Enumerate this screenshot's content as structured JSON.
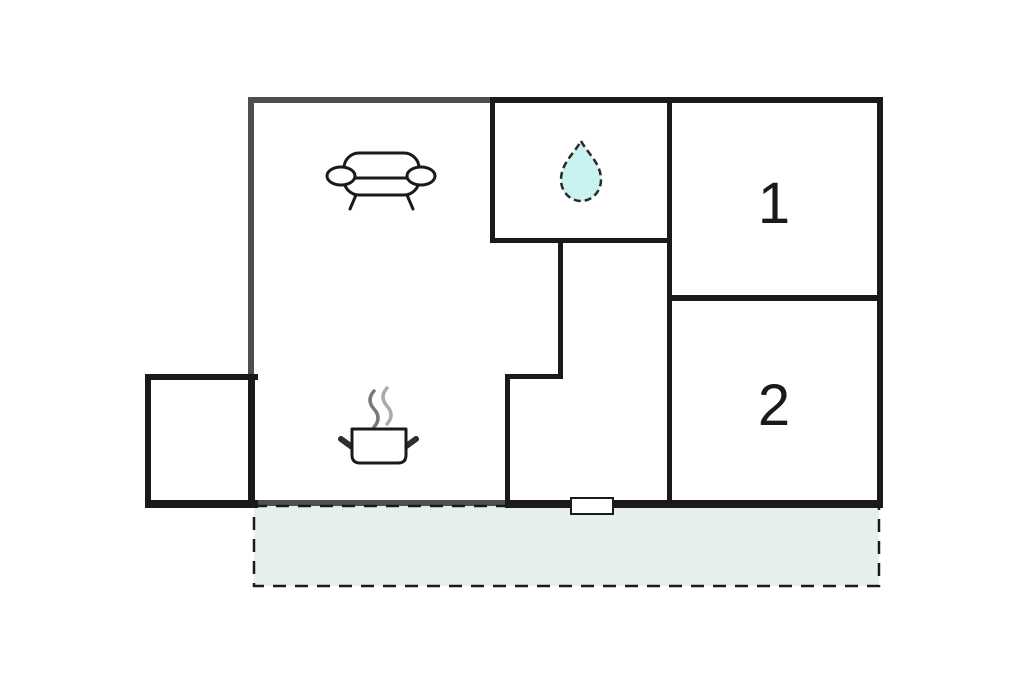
{
  "floor_plan": {
    "type": "apartment-floor-plan",
    "room_labels": {
      "room_1": "1",
      "room_2": "2"
    },
    "rooms": [
      {
        "name": "living-room",
        "icon": "sofa-icon",
        "label": ""
      },
      {
        "name": "bathroom",
        "icon": "water-drop-icon",
        "label": ""
      },
      {
        "name": "bedroom-1",
        "icon": "",
        "label": "1"
      },
      {
        "name": "bedroom-2",
        "icon": "",
        "label": "2"
      },
      {
        "name": "kitchen-area",
        "icon": "cooking-pot-icon",
        "label": ""
      },
      {
        "name": "annex",
        "icon": "",
        "label": ""
      },
      {
        "name": "hallway",
        "icon": "",
        "label": ""
      },
      {
        "name": "terrace",
        "icon": "",
        "label": ""
      }
    ],
    "icons": [
      "sofa-icon",
      "water-drop-icon",
      "cooking-pot-icon",
      "steam-icon",
      "entrance-door"
    ],
    "colors": {
      "background": "#ffffff",
      "wall_dark": "#1a1a1a",
      "wall_gray": "#4f4f4f",
      "terrace_fill": "#e7efec",
      "terrace_dash": "#1a1a1a",
      "drop_fill": "#c9f3f0",
      "drop_outline": "#2a2a2a",
      "steam_dark": "#787878",
      "steam_light": "#ababab",
      "door_fill": "#ffffff",
      "label_color": "#1a1a1a"
    }
  }
}
